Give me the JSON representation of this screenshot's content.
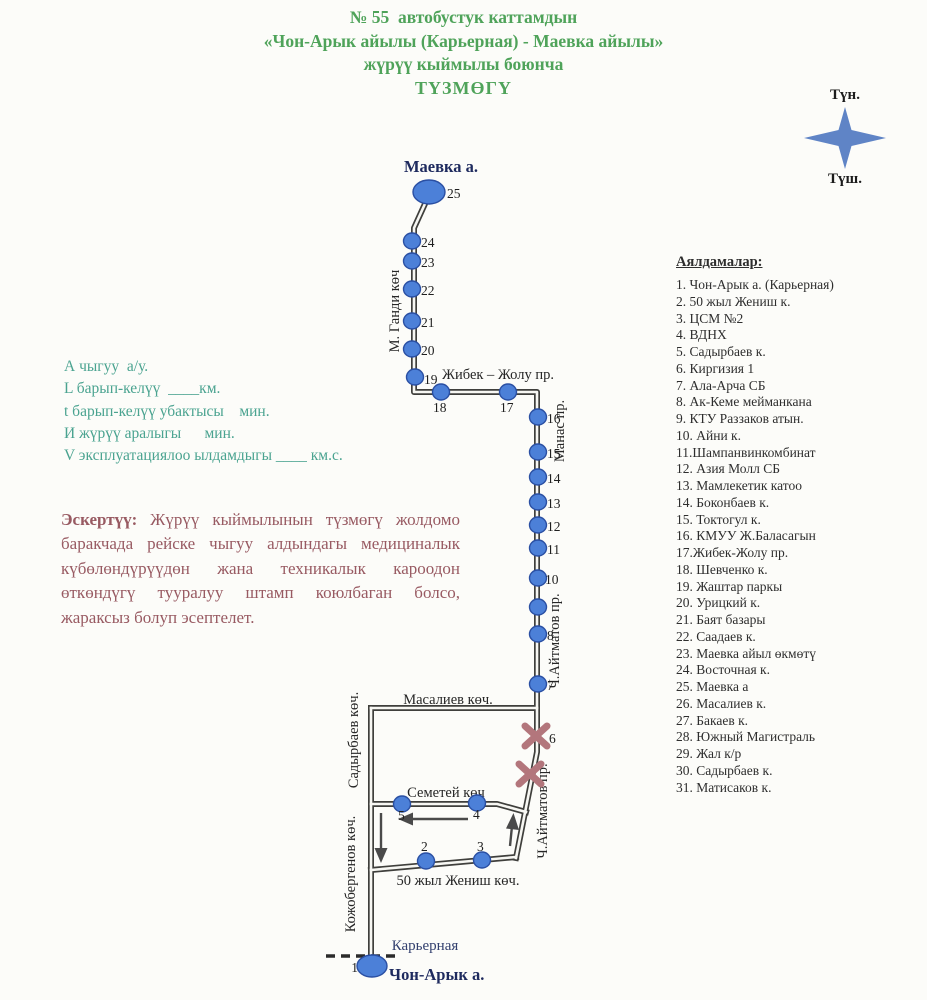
{
  "header": {
    "line1": "№ 55  автобустук каттамдын",
    "line2": "«Чон-Арык айылы (Карьерная) - Маевка айылы»",
    "line3": "жүрүү кыймылы боюнча",
    "line4": "ТҮЗМӨГҮ"
  },
  "compass": {
    "north": "Түн.",
    "south": "Түш."
  },
  "params": {
    "lines": [
      "А чыгуу  а/у.",
      "L барып-келүү  ____км.",
      "t барып-келүү убактысы    мин.",
      "И жүрүү аралыгы      мин.",
      "V эксплуатациялоо ылдамдыгы ____ км.с."
    ]
  },
  "note": {
    "lead": "Эскертүү:",
    "body": " Жүрүү кыймылынын түзмөгү жолдомо баракчада рейске чыгуу алдындагы медициналык күбөлөндүрүүдөн жана техникалык кароодон өткөндүгү тууралуу штамп коюлбаган болсо, жараксыз болуп эсептелет."
  },
  "legend": {
    "title": "Аялдамалар:",
    "items": [
      "1. Чон-Арык а. (Карьерная)",
      "2. 50 жыл Жениш к.",
      "3. ЦСМ №2",
      "4. ВДНХ",
      "5. Садырбаев к.",
      "6. Киргизия 1",
      "7. Ала-Арча СБ",
      "8. Ак-Кеме мейманкана",
      "9. КТУ Раззаков атын.",
      "10. Айни к.",
      "11.Шампанвинкомбинат",
      "12. Азия Молл СБ",
      "13. Мамлекетик катоо",
      "14. Боконбаев к.",
      "15. Токтогул к.",
      "16. КМУУ Ж.Баласагын",
      "17.Жибек-Жолу пр.",
      "18. Шевченко к.",
      "19. Жаштар паркы",
      "20. Урицкий к.",
      "21. Баят базары",
      "22. Саадаев к.",
      "23. Маевка айыл өкмөтү",
      "24. Восточная к.",
      "25. Маевка а",
      "26. Масалиев к.",
      "27. Бакаев к.",
      "28. Южный Магистраль",
      "29. Жал к/р",
      "30. Садырбаев к.",
      "31. Матисаков к."
    ]
  },
  "map": {
    "stops": [
      {
        "n": "25",
        "x": 429,
        "y": 192,
        "rx": 16,
        "ry": 12,
        "lx": 447,
        "ly": 198
      },
      {
        "n": "24",
        "x": 412,
        "y": 241,
        "lx": 421,
        "ly": 247
      },
      {
        "n": "23",
        "x": 412,
        "y": 261,
        "lx": 421,
        "ly": 267
      },
      {
        "n": "22",
        "x": 412,
        "y": 289,
        "lx": 421,
        "ly": 295
      },
      {
        "n": "21",
        "x": 412,
        "y": 321,
        "lx": 421,
        "ly": 327
      },
      {
        "n": "20",
        "x": 412,
        "y": 349,
        "lx": 421,
        "ly": 355
      },
      {
        "n": "19",
        "x": 415,
        "y": 377,
        "lx": 424,
        "ly": 384
      },
      {
        "n": "18",
        "x": 441,
        "y": 392,
        "lx": 433,
        "ly": 412
      },
      {
        "n": "17",
        "x": 508,
        "y": 392,
        "lx": 500,
        "ly": 412
      },
      {
        "n": "16",
        "x": 538,
        "y": 417,
        "lx": 547,
        "ly": 423
      },
      {
        "n": "15",
        "x": 538,
        "y": 452,
        "lx": 547,
        "ly": 458
      },
      {
        "n": "14",
        "x": 538,
        "y": 477,
        "lx": 547,
        "ly": 483
      },
      {
        "n": "13",
        "x": 538,
        "y": 502,
        "lx": 547,
        "ly": 508
      },
      {
        "n": "12",
        "x": 538,
        "y": 525,
        "lx": 547,
        "ly": 531
      },
      {
        "n": "11",
        "x": 538,
        "y": 548,
        "lx": 547,
        "ly": 554
      },
      {
        "n": "10",
        "x": 538,
        "y": 578,
        "lx": 545,
        "ly": 584
      },
      {
        "n": "",
        "x": 538,
        "y": 607
      },
      {
        "n": "8",
        "x": 538,
        "y": 634,
        "lx": 547,
        "ly": 640
      },
      {
        "n": "7",
        "x": 538,
        "y": 684,
        "lx": 547,
        "ly": 690
      },
      {
        "n": "5",
        "x": 402,
        "y": 804,
        "lx": 398,
        "ly": 820
      },
      {
        "n": "4",
        "x": 477,
        "y": 803,
        "lx": 473,
        "ly": 819
      },
      {
        "n": "3",
        "x": 482,
        "y": 860,
        "lx": 477,
        "ly": 851
      },
      {
        "n": "2",
        "x": 426,
        "y": 861,
        "lx": 421,
        "ly": 851
      },
      {
        "n": "1",
        "x": 372,
        "y": 966,
        "rx": 15,
        "ry": 11,
        "lx": 358,
        "ly": 972,
        "anchor": "end"
      }
    ],
    "crossed_stops": [
      {
        "x": 536,
        "y": 736,
        "n": "6",
        "lx": 549,
        "ly": 743
      },
      {
        "x": 530,
        "y": 774,
        "n": ""
      }
    ],
    "street_labels": [
      {
        "t": "Маевка а.",
        "x": 441,
        "y": 172,
        "cls": "terminal"
      },
      {
        "t": "М. Ганди көч",
        "x": 399,
        "y": 311,
        "rot": -90
      },
      {
        "t": "Жибек – Жолу пр.",
        "x": 498,
        "y": 379
      },
      {
        "t": "Манас пр.",
        "x": 564,
        "y": 431,
        "rot": -90
      },
      {
        "t": "Ч.Айтматов пр.",
        "x": 559,
        "y": 641,
        "rot": -90
      },
      {
        "t": "Масалиев көч.",
        "x": 448,
        "y": 704
      },
      {
        "t": "Садырбаев көч.",
        "x": 358,
        "y": 740,
        "rot": -90
      },
      {
        "t": "Семетей көч",
        "x": 446,
        "y": 797
      },
      {
        "t": "Ч.Айтматов пр.",
        "x": 547,
        "y": 811,
        "rot": -90
      },
      {
        "t": "Кожобергенов көч.",
        "x": 355,
        "y": 874,
        "rot": -90
      },
      {
        "t": "50 жыл Жениш көч.",
        "x": 458,
        "y": 885
      },
      {
        "t": "Карьерная",
        "x": 425,
        "y": 950,
        "cls": "road-name-blue"
      },
      {
        "t": "Чон-Арык а.",
        "x": 389,
        "y": 980,
        "cls": "terminal",
        "anchor": "start"
      }
    ]
  },
  "colors": {
    "title_green": "#4fa35a",
    "param_teal": "#4aa390",
    "note_maroon": "#985a62",
    "stop_blue": "#4c80d8",
    "stop_border": "#2a4fa3",
    "road": "#3f3f3c",
    "terminal_navy": "#1e2a5e",
    "compass_blue": "#5f84c6",
    "closed_x": "#b3767c"
  }
}
